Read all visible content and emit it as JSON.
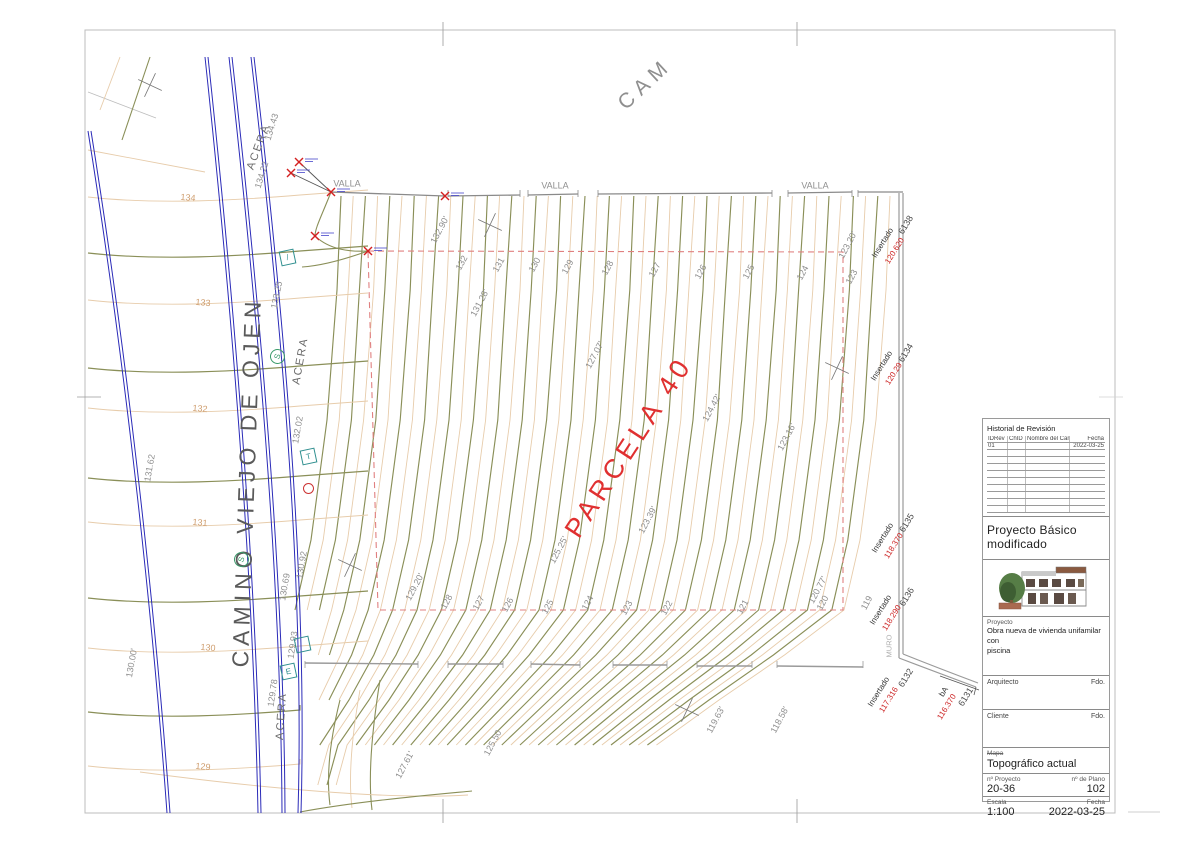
{
  "sheet": {
    "frame_note": "plan sheet frame"
  },
  "colors": {
    "index": "#8a8f58",
    "inter": "#e7ccab",
    "road": "#2b2bb8",
    "boundary": "#e08080",
    "fence": "#8a8a8a",
    "wall": "#9a9a9a",
    "g": "#8f8f8f",
    "t": "#cf9e6f",
    "k": "#333333",
    "r": "#cc2222",
    "w": "#4a4a4a",
    "m": "#b0b0b0",
    "st": "#5a5a5a",
    "ac": "#6a6a6a",
    "big": "#e03030"
  },
  "parcel": {
    "label": "PARCELA 40"
  },
  "road": {
    "name": "CAMINO VIEJO DE OJEN"
  },
  "top_street": {
    "label": "CAM"
  },
  "map_labels": [
    {
      "t": "PARCELA 40",
      "x": 629,
      "y": 447,
      "r": -57,
      "c": "big",
      "s": 27,
      "ls": 5,
      "n": "parcel-label"
    },
    {
      "t": "CAMINO VIEJO DE OJEN",
      "x": 247,
      "y": 482,
      "r": -88,
      "c": "st",
      "s": 23,
      "ls": 5,
      "n": "street-name"
    },
    {
      "t": "CAM",
      "x": 645,
      "y": 84,
      "r": -43,
      "c": "g",
      "s": 21,
      "ls": 6,
      "n": "street-name-top"
    },
    {
      "t": "ACERA",
      "x": 259,
      "y": 147,
      "r": -70,
      "c": "ac",
      "s": 11,
      "ls": 2,
      "n": "sidewalk-label"
    },
    {
      "t": "ACERA",
      "x": 301,
      "y": 361,
      "r": -80,
      "c": "ac",
      "s": 11,
      "ls": 2,
      "n": "sidewalk-label"
    },
    {
      "t": "ACERA",
      "x": 282,
      "y": 716,
      "r": -86,
      "c": "ac",
      "s": 11,
      "ls": 2,
      "n": "sidewalk-label"
    },
    {
      "t": "VALLA",
      "x": 347,
      "y": 184,
      "r": 0,
      "c": "g",
      "s": 9,
      "n": "fence-label"
    },
    {
      "t": "VALLA",
      "x": 555,
      "y": 186,
      "r": 0,
      "c": "g",
      "s": 9,
      "n": "fence-label"
    },
    {
      "t": "VALLA",
      "x": 815,
      "y": 186,
      "r": 0,
      "c": "g",
      "s": 9,
      "n": "fence-label"
    },
    {
      "t": "134.43",
      "x": 272,
      "y": 127,
      "r": -73,
      "c": "g",
      "s": 9
    },
    {
      "t": "134.22",
      "x": 262,
      "y": 175,
      "r": -73,
      "c": "g",
      "s": 9
    },
    {
      "t": "133.25",
      "x": 277,
      "y": 295,
      "r": -78,
      "c": "g",
      "s": 9
    },
    {
      "t": "132.02",
      "x": 298,
      "y": 430,
      "r": -80,
      "c": "g",
      "s": 9
    },
    {
      "t": "131.62",
      "x": 150,
      "y": 468,
      "r": -80,
      "c": "g",
      "s": 9
    },
    {
      "t": "130.92",
      "x": 302,
      "y": 565,
      "r": -80,
      "c": "g",
      "s": 9
    },
    {
      "t": "130.69",
      "x": 285,
      "y": 587,
      "r": -80,
      "c": "g",
      "s": 9
    },
    {
      "t": "129.93",
      "x": 293,
      "y": 645,
      "r": -82,
      "c": "g",
      "s": 9
    },
    {
      "t": "129.78",
      "x": 273,
      "y": 693,
      "r": -82,
      "c": "g",
      "s": 9
    },
    {
      "t": "130.00'",
      "x": 132,
      "y": 663,
      "r": -80,
      "c": "g",
      "s": 9
    },
    {
      "t": "134",
      "x": 188,
      "y": 198,
      "r": 5,
      "c": "t",
      "s": 9
    },
    {
      "t": "133",
      "x": 203,
      "y": 303,
      "r": 5,
      "c": "t",
      "s": 9
    },
    {
      "t": "132",
      "x": 200,
      "y": 409,
      "r": 5,
      "c": "t",
      "s": 9
    },
    {
      "t": "131",
      "x": 200,
      "y": 523,
      "r": 5,
      "c": "t",
      "s": 9
    },
    {
      "t": "130",
      "x": 208,
      "y": 648,
      "r": 5,
      "c": "t",
      "s": 9
    },
    {
      "t": "129",
      "x": 203,
      "y": 767,
      "r": 5,
      "c": "t",
      "s": 9
    },
    {
      "t": "132.90'",
      "x": 440,
      "y": 230,
      "r": -62,
      "c": "g",
      "s": 9
    },
    {
      "t": "132",
      "x": 462,
      "y": 263,
      "r": -62,
      "c": "g",
      "s": 9
    },
    {
      "t": "131",
      "x": 499,
      "y": 265,
      "r": -62,
      "c": "g",
      "s": 9
    },
    {
      "t": "131.28'",
      "x": 480,
      "y": 303,
      "r": -62,
      "c": "g",
      "s": 9
    },
    {
      "t": "130",
      "x": 535,
      "y": 265,
      "r": -62,
      "c": "g",
      "s": 9
    },
    {
      "t": "129",
      "x": 568,
      "y": 267,
      "r": -62,
      "c": "g",
      "s": 9
    },
    {
      "t": "128",
      "x": 608,
      "y": 268,
      "r": -62,
      "c": "g",
      "s": 9
    },
    {
      "t": "127",
      "x": 655,
      "y": 270,
      "r": -62,
      "c": "g",
      "s": 9
    },
    {
      "t": "126",
      "x": 701,
      "y": 272,
      "r": -62,
      "c": "g",
      "s": 9
    },
    {
      "t": "125",
      "x": 749,
      "y": 272,
      "r": -62,
      "c": "g",
      "s": 9
    },
    {
      "t": "124",
      "x": 803,
      "y": 273,
      "r": -62,
      "c": "g",
      "s": 9
    },
    {
      "t": "123.20'",
      "x": 848,
      "y": 245,
      "r": -62,
      "c": "g",
      "s": 9
    },
    {
      "t": "123",
      "x": 852,
      "y": 277,
      "r": -62,
      "c": "g",
      "s": 9
    },
    {
      "t": "127.07'",
      "x": 595,
      "y": 355,
      "r": -62,
      "c": "g",
      "s": 9
    },
    {
      "t": "124.42'",
      "x": 712,
      "y": 408,
      "r": -62,
      "c": "g",
      "s": 9
    },
    {
      "t": "123.16'",
      "x": 787,
      "y": 437,
      "r": -62,
      "c": "g",
      "s": 9
    },
    {
      "t": "123.39'",
      "x": 648,
      "y": 520,
      "r": -62,
      "c": "g",
      "s": 9
    },
    {
      "t": "125.25'",
      "x": 559,
      "y": 550,
      "r": -62,
      "c": "g",
      "s": 9
    },
    {
      "t": "129.20'",
      "x": 415,
      "y": 587,
      "r": -62,
      "c": "g",
      "s": 9
    },
    {
      "t": "128",
      "x": 447,
      "y": 602,
      "r": -62,
      "c": "g",
      "s": 9
    },
    {
      "t": "127",
      "x": 479,
      "y": 603,
      "r": -62,
      "c": "g",
      "s": 9
    },
    {
      "t": "126",
      "x": 508,
      "y": 605,
      "r": -62,
      "c": "g",
      "s": 9
    },
    {
      "t": "125",
      "x": 548,
      "y": 607,
      "r": -62,
      "c": "g",
      "s": 9
    },
    {
      "t": "124",
      "x": 588,
      "y": 603,
      "r": -62,
      "c": "g",
      "s": 9
    },
    {
      "t": "123",
      "x": 627,
      "y": 608,
      "r": -62,
      "c": "g",
      "s": 9
    },
    {
      "t": "122",
      "x": 667,
      "y": 608,
      "r": -62,
      "c": "g",
      "s": 9
    },
    {
      "t": "121",
      "x": 743,
      "y": 607,
      "r": -62,
      "c": "g",
      "s": 9
    },
    {
      "t": "120.77'",
      "x": 818,
      "y": 590,
      "r": -62,
      "c": "g",
      "s": 9
    },
    {
      "t": "120",
      "x": 823,
      "y": 603,
      "r": -62,
      "c": "g",
      "s": 9
    },
    {
      "t": "119",
      "x": 867,
      "y": 603,
      "r": -62,
      "c": "g",
      "s": 9
    },
    {
      "t": "125.50",
      "x": 493,
      "y": 743,
      "r": -62,
      "c": "g",
      "s": 9
    },
    {
      "t": "127.61'",
      "x": 405,
      "y": 765,
      "r": -62,
      "c": "g",
      "s": 9
    },
    {
      "t": "119.63'",
      "x": 716,
      "y": 720,
      "r": -62,
      "c": "g",
      "s": 9
    },
    {
      "t": "118.58'",
      "x": 780,
      "y": 720,
      "r": -62,
      "c": "g",
      "s": 9
    },
    {
      "t": "6138",
      "x": 906,
      "y": 225,
      "r": -58,
      "c": "w",
      "s": 9,
      "n": "wall-point-id"
    },
    {
      "t": "Insertado",
      "x": 883,
      "y": 243,
      "r": -58,
      "c": "k",
      "s": 8,
      "n": "inserted-label"
    },
    {
      "t": "120.620",
      "x": 895,
      "y": 251,
      "r": -58,
      "c": "r",
      "s": 8,
      "n": "inserted-elevation"
    },
    {
      "t": "6134",
      "x": 906,
      "y": 353,
      "r": -58,
      "c": "w",
      "s": 9,
      "n": "wall-point-id"
    },
    {
      "t": "Insertado",
      "x": 882,
      "y": 366,
      "r": -58,
      "c": "k",
      "s": 8,
      "n": "inserted-label"
    },
    {
      "t": "120.29",
      "x": 894,
      "y": 374,
      "r": -58,
      "c": "r",
      "s": 8,
      "n": "inserted-elevation"
    },
    {
      "t": "6135",
      "x": 907,
      "y": 523,
      "r": -58,
      "c": "w",
      "s": 9,
      "n": "wall-point-id"
    },
    {
      "t": "Insertado",
      "x": 883,
      "y": 538,
      "r": -58,
      "c": "k",
      "s": 8,
      "n": "inserted-label"
    },
    {
      "t": "118.370",
      "x": 894,
      "y": 546,
      "r": -58,
      "c": "r",
      "s": 8,
      "n": "inserted-elevation"
    },
    {
      "t": "6136",
      "x": 907,
      "y": 597,
      "r": -58,
      "c": "w",
      "s": 9,
      "n": "wall-point-id"
    },
    {
      "t": "Insertado",
      "x": 881,
      "y": 610,
      "r": -58,
      "c": "k",
      "s": 8,
      "n": "inserted-label"
    },
    {
      "t": "118.290",
      "x": 892,
      "y": 618,
      "r": -58,
      "c": "r",
      "s": 8,
      "n": "inserted-elevation"
    },
    {
      "t": "6132",
      "x": 906,
      "y": 678,
      "r": -58,
      "c": "w",
      "s": 9,
      "n": "wall-point-id"
    },
    {
      "t": "Insertado",
      "x": 879,
      "y": 692,
      "r": -58,
      "c": "k",
      "s": 8,
      "n": "inserted-label"
    },
    {
      "t": "117.316",
      "x": 889,
      "y": 700,
      "r": -58,
      "c": "r",
      "s": 8,
      "n": "inserted-elevation"
    },
    {
      "t": "bA",
      "x": 944,
      "y": 692,
      "r": -58,
      "c": "k",
      "s": 8
    },
    {
      "t": "116.370",
      "x": 947,
      "y": 707,
      "r": -58,
      "c": "r",
      "s": 8,
      "n": "inserted-elevation"
    },
    {
      "t": "6131",
      "x": 966,
      "y": 697,
      "r": -58,
      "c": "w",
      "s": 9,
      "n": "wall-point-id"
    },
    {
      "t": "MURO",
      "x": 889,
      "y": 646,
      "r": -90,
      "c": "m",
      "s": 7.5,
      "n": "wall-label"
    }
  ],
  "symbols": [
    {
      "type": "box",
      "t": "/",
      "x": 286,
      "y": 256,
      "n": "utility-slash-symbol"
    },
    {
      "type": "circle",
      "t": "S",
      "x": 276,
      "y": 355,
      "n": "sewer-symbol"
    },
    {
      "type": "box",
      "t": "T",
      "x": 307,
      "y": 455,
      "n": "telecom-symbol"
    },
    {
      "type": "circle-red",
      "t": "",
      "x": 307,
      "y": 487,
      "n": "utility-red-symbol"
    },
    {
      "type": "circle",
      "t": "S",
      "x": 240,
      "y": 558,
      "n": "sewer-symbol"
    },
    {
      "type": "box",
      "t": "E",
      "x": 287,
      "y": 670,
      "n": "electric-symbol"
    },
    {
      "type": "box",
      "t": "",
      "x": 301,
      "y": 643,
      "n": "utility-box-symbol"
    }
  ],
  "title_block": {
    "revision": {
      "title": "Historial de Revisión",
      "headers": [
        "IDRev",
        "ChID",
        "Nombre del Cambio",
        "Fecha"
      ],
      "row1": {
        "id": "01",
        "chid": "",
        "name": "",
        "date": "2022-03-25"
      }
    },
    "project_title": "Proyecto Básico modificado",
    "project_label": "Proyecto",
    "project_desc_line1": "Obra nueva de vivienda unifamilar con",
    "project_desc_line2": "piscina",
    "architect_label": "Arquitecto",
    "architect_sign": "Fdo.",
    "client_label": "Cliente",
    "client_sign": "Fdo.",
    "map_label": "Mapa",
    "map_title": "Topográfico actual",
    "project_no_label": "nº Proyecto",
    "project_no": "20-36",
    "plan_no_label": "nº de Plano",
    "plan_no": "102",
    "scale_label": "Escala",
    "scale": "1:100",
    "date_label": "Fecha",
    "date": "2022-03-25"
  }
}
